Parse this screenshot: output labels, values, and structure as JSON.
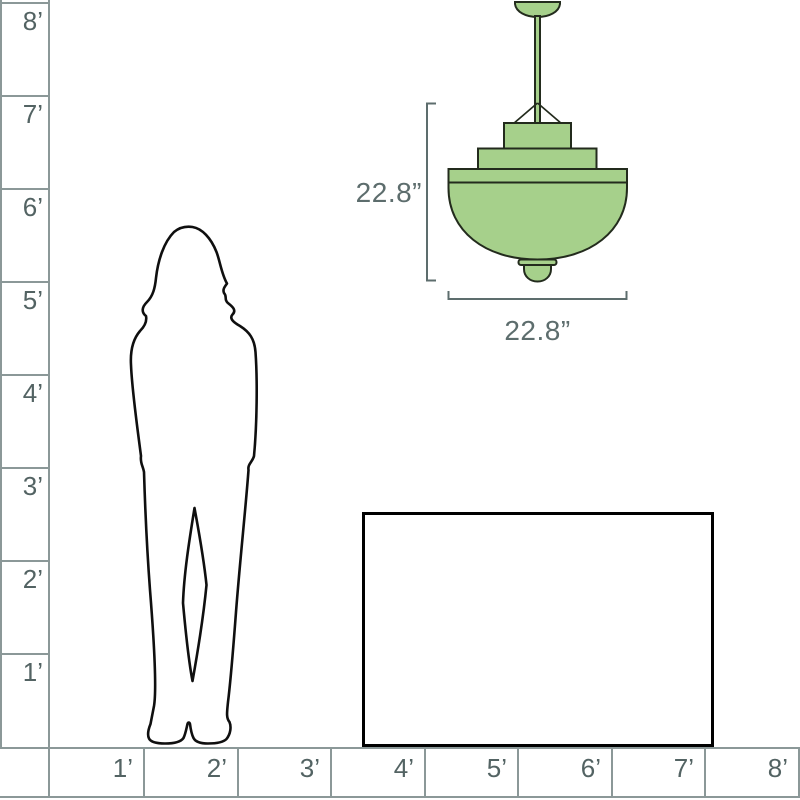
{
  "colors": {
    "background": "#ffffff",
    "ruler_line": "#8b9898",
    "ruler_text": "#536363",
    "dimension": "#5d6d6d",
    "fixture_fill": "#a6d08b",
    "fixture_stroke": "#232b1d",
    "silhouette_stroke": "#0f0f0f",
    "table_stroke": "#000000"
  },
  "ruler": {
    "vertical": {
      "unit": "feet",
      "labels": [
        "8’",
        "7’",
        "6’",
        "5’",
        "4’",
        "3’",
        "2’",
        "1’"
      ]
    },
    "horizontal": {
      "unit": "feet",
      "labels": [
        "1’",
        "2’",
        "3’",
        "4’",
        "5’",
        "6’",
        "7’",
        "8’"
      ]
    }
  },
  "fixture": {
    "kind": "pendant-light-drawing",
    "height_label": "22.8”",
    "width_label": "22.8”"
  },
  "scene": {
    "person": "woman-silhouette",
    "furniture": "table-outline"
  }
}
